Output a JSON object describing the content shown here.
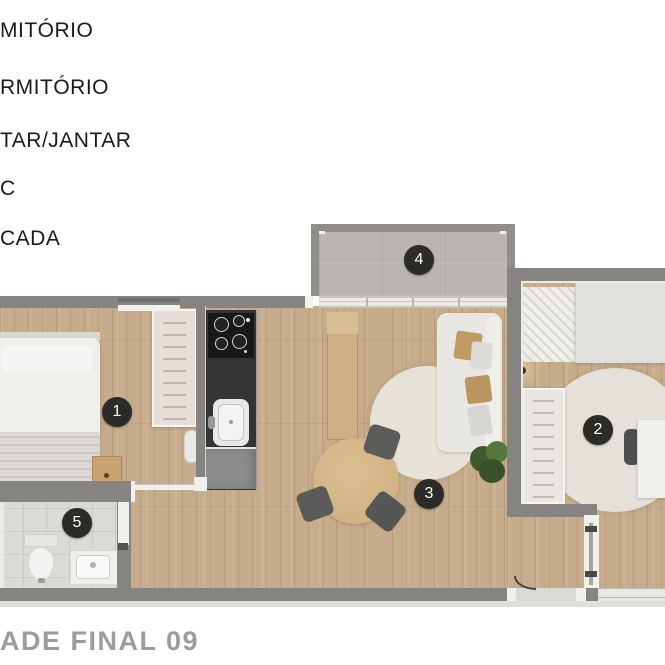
{
  "legend": {
    "items": [
      {
        "label": "MITÓRIO"
      },
      {
        "label": "RMITÓRIO"
      },
      {
        "label": "TAR/JANTAR"
      },
      {
        "label": "C"
      },
      {
        "label": "CADA"
      }
    ]
  },
  "footer": {
    "title": "ADE FINAL 09"
  },
  "floorplan": {
    "rooms": [
      {
        "number": "1"
      },
      {
        "number": "2"
      },
      {
        "number": "3"
      },
      {
        "number": "4"
      },
      {
        "number": "5"
      }
    ],
    "colors": {
      "wall": "#858480",
      "wood_floor": "#c6ac8a",
      "tile_floor": "#dbdad7",
      "balcony_floor": "#b9b6b1",
      "marker_background": "#2c2b28",
      "marker_text": "#ffffff",
      "legend_text": "#1b1b1b",
      "title_text": "#9c9c9c",
      "cushion_tan": "#c09a63",
      "counter_dark": "#343437"
    }
  }
}
